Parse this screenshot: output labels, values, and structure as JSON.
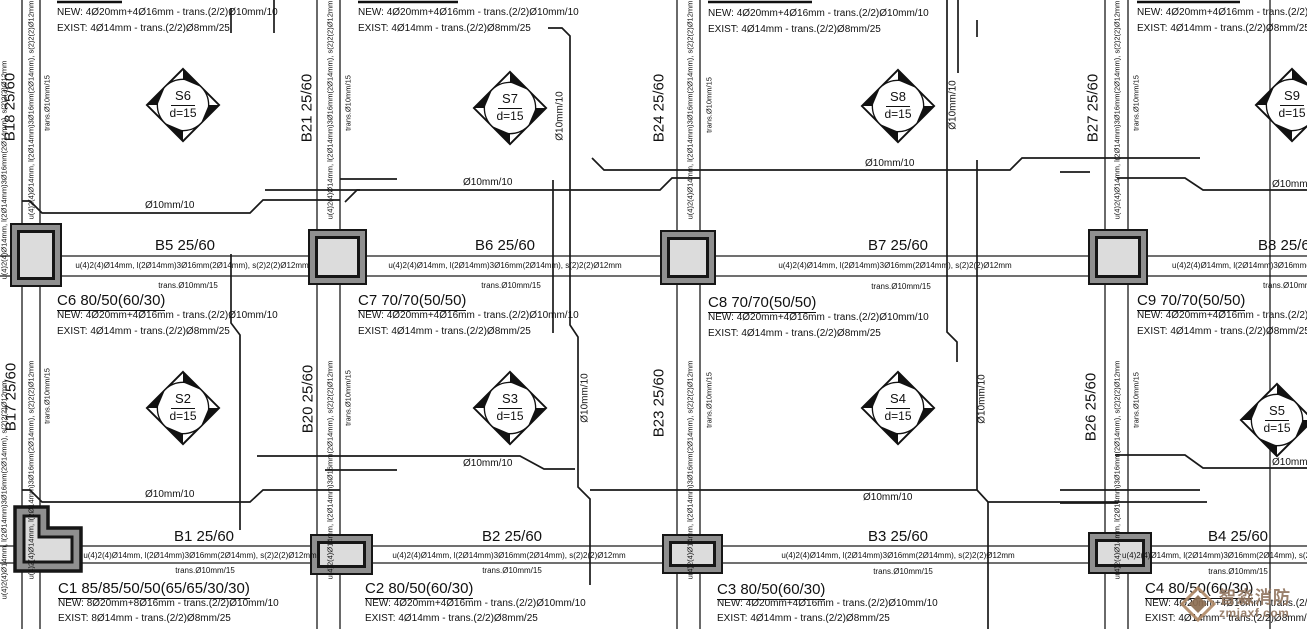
{
  "drawing": {
    "beam_annotation_main": "u(4)2(4)Ø14mm, l(2Ø14mm)3Ø16mm(2Ø14mm), s(2)2(2)Ø12mm",
    "beam_annotation_trans": "trans.Ø10mm/15",
    "rebar_label": "Ø10mm/10",
    "slab_thickness": "d=15"
  },
  "h_beams": [
    {
      "label": "B5 25/60"
    },
    {
      "label": "B6 25/60"
    },
    {
      "label": "B7 25/60"
    },
    {
      "label": "B8 25/60"
    },
    {
      "label": "B1 25/60"
    },
    {
      "label": "B2 25/60"
    },
    {
      "label": "B3 25/60"
    },
    {
      "label": "B4 25/60"
    }
  ],
  "v_beams": [
    {
      "label": "B18 25/60"
    },
    {
      "label": "B17 25/60"
    },
    {
      "label": "B21 25/60"
    },
    {
      "label": "B20 25/60"
    },
    {
      "label": "B24 25/60"
    },
    {
      "label": "B23 25/60"
    },
    {
      "label": "B27 25/60"
    },
    {
      "label": "B26 25/60"
    }
  ],
  "slabs": [
    {
      "name": "S6"
    },
    {
      "name": "S7"
    },
    {
      "name": "S8"
    },
    {
      "name": "S9"
    },
    {
      "name": "S2"
    },
    {
      "name": "S3"
    },
    {
      "name": "S4"
    },
    {
      "name": "S5"
    }
  ],
  "columns_top_row": [
    {
      "new": "NEW: 4Ø20mm+4Ø16mm - trans.(2/2)Ø10mm/10",
      "exist": "EXIST: 4Ø14mm - trans.(2/2)Ø8mm/25"
    },
    {
      "new": "NEW: 4Ø20mm+4Ø16mm - trans.(2/2)Ø10mm/10",
      "exist": "EXIST: 4Ø14mm - trans.(2/2)Ø8mm/25"
    },
    {
      "new": "NEW: 4Ø20mm+4Ø16mm - trans.(2/2)Ø10mm/10",
      "exist": "EXIST: 4Ø14mm - trans.(2/2)Ø8mm/25"
    },
    {
      "new": "NEW: 4Ø20mm+4Ø16mm - trans.(2/2)Ø10mm/10",
      "exist": "EXIST: 4Ø14mm - trans.(2/2)Ø8mm/25"
    }
  ],
  "columns_mid_row": [
    {
      "title": "C6 80/50(60/30)",
      "new": "NEW: 4Ø20mm+4Ø16mm - trans.(2/2)Ø10mm/10",
      "exist": "EXIST: 4Ø14mm - trans.(2/2)Ø8mm/25"
    },
    {
      "title": "C7 70/70(50/50)",
      "new": "NEW: 4Ø20mm+4Ø16mm - trans.(2/2)Ø10mm/10",
      "exist": "EXIST: 4Ø14mm - trans.(2/2)Ø8mm/25"
    },
    {
      "title": "C8 70/70(50/50)",
      "new": "NEW: 4Ø20mm+4Ø16mm - trans.(2/2)Ø10mm/10",
      "exist": "EXIST: 4Ø14mm - trans.(2/2)Ø8mm/25"
    },
    {
      "title": "C9 70/70(50/50)",
      "new": "NEW: 4Ø20mm+4Ø16mm - trans.(2/2)Ø10mm/10",
      "exist": "EXIST: 4Ø14mm - trans.(2/2)Ø8mm/25"
    }
  ],
  "columns_bottom_row": [
    {
      "title": "C1 85/85/50/50(65/65/30/30)",
      "new": "NEW: 8Ø20mm+8Ø16mm - trans.(2/2)Ø10mm/10",
      "exist": "EXIST: 8Ø14mm - trans.(2/2)Ø8mm/25"
    },
    {
      "title": "C2 80/50(60/30)",
      "new": "NEW: 4Ø20mm+4Ø16mm - trans.(2/2)Ø10mm/10",
      "exist": "EXIST: 4Ø14mm - trans.(2/2)Ø8mm/25"
    },
    {
      "title": "C3 80/50(60/30)",
      "new": "NEW: 4Ø20mm+4Ø16mm - trans.(2/2)Ø10mm/10",
      "exist": "EXIST: 4Ø14mm - trans.(2/2)Ø8mm/25"
    },
    {
      "title": "C4 80/50(60/30)",
      "new": "NEW: 4Ø20mm+4Ø16mm - trans.(2/2)Ø10mm/10",
      "exist": "EXIST: 4Ø14mm - trans.(2/2)Ø8mm/25"
    }
  ],
  "watermark": {
    "brand": "智淼消防",
    "site": "zmjaxf.com"
  },
  "colors": {
    "line": "#1a1a1a",
    "column_band": "#8f8f8f",
    "column_fill": "#dcdcdc",
    "watermark": "#927660"
  }
}
